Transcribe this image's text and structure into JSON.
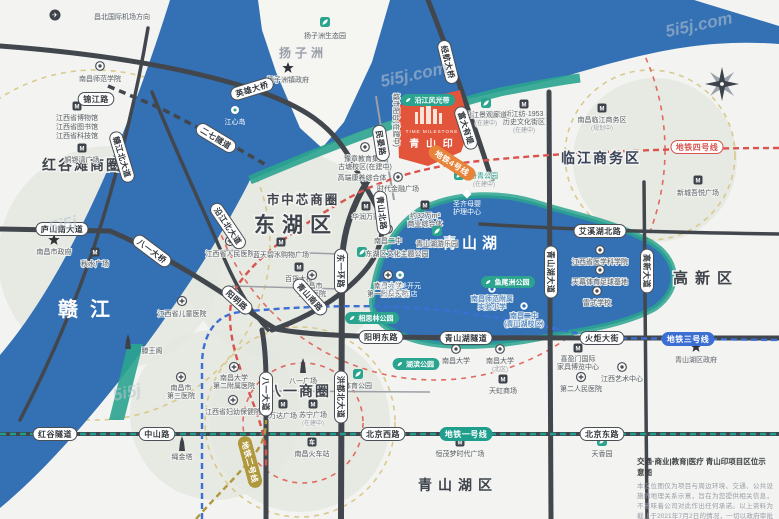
{
  "title": "青山印项目区位示意图",
  "palette": {
    "water": "#3470b4",
    "teal": "#2aa48e",
    "road_dark": "#42474d",
    "road_minor": "#9aa0a6",
    "blob": "#e4e6e1",
    "yellow_dash": "#d8c98c",
    "red_dash": "#e06b5f",
    "metro1": "#1f9e8e",
    "metro2": "#b0983c",
    "metro3": "#3b6fd4",
    "metro4": "#d9534f",
    "orange": "#e8833a",
    "project": "#e2553b"
  },
  "water": {
    "river_path": "M170,0 L694,0 L779,26 L779,44 C700,38 640,54 560,78 C480,96 420,108 360,132 C330,143 300,160 250,180 C220,240 180,300 120,380 C80,430 40,475 0,508 L0,355 C60,285 120,160 170,0 Z",
    "island_path": "M258,0 L390,0 L372,62 L344,122 L322,148 L300,128 L276,72 L262,30 Z",
    "shore_path": "M250,180 C330,146 420,112 500,92 C535,85 558,81 580,78",
    "tengwang_quad": "M128,344 L143,344 L124,420 L109,420 Z",
    "lake_path": "M372,302 C375,262 392,228 420,210 C455,192 500,191 540,204 C575,215 615,222 650,242 C678,258 683,288 655,308 C625,325 580,331 540,338 C500,346 450,350 415,340 C390,332 372,322 372,302 Z"
  },
  "blobs": [
    [
      285,
      255,
      105
    ],
    [
      110,
      258,
      112
    ],
    [
      655,
      160,
      82
    ],
    [
      300,
      422,
      90
    ],
    [
      215,
      415,
      85
    ]
  ],
  "circles": {
    "yellow": [
      [
        95,
        245,
        175
      ],
      [
        300,
        422,
        95
      ],
      [
        650,
        155,
        85
      ]
    ],
    "red": [
      [
        303,
        423,
        60
      ],
      [
        435,
        150,
        230
      ]
    ]
  },
  "roads": {
    "dark": [
      [
        "M0,46 C120,55 200,72 255,90 C302,106 332,124 352,162 C368,193 382,210 382,228 C382,252 368,272 340,294 C318,311 295,322 272,330",
        5
      ],
      [
        "M0,229 L110,231 C152,249 192,273 230,298 C252,313 263,322 276,329 C330,339 420,338 779,338",
        5
      ],
      [
        "M152,92 C176,152 200,202 221,251 C236,287 251,312 268,330",
        3.5
      ],
      [
        "M148,28 C136,100 116,180 93,250 C76,300 51,360 20,420",
        3.5
      ],
      [
        "M368,180 C352,206 343,232 342,262 L341,519",
        6
      ],
      [
        "M262,330 C265,346 266,362 266,382 L266,519",
        5
      ],
      [
        "M0,434 L779,434",
        4
      ],
      [
        "M549,92 L551,519",
        5
      ],
      [
        "M644,182 L647,519",
        3.5
      ],
      [
        "M480,224 C560,229 640,232 779,234",
        3.5
      ],
      [
        "M428,0 C444,40 458,80 470,115 C479,140 486,162 492,180",
        5
      ]
    ],
    "minor": [
      [
        "M376,96 C381,130 388,165 394,200",
        2
      ],
      [
        "M220,250 L340,254",
        1.5
      ],
      [
        "M232,286 L341,289",
        1.5
      ],
      [
        "M266,391 L430,392",
        1.5
      ]
    ],
    "dashed": [
      [
        "M108,86 L160,108 L230,144 L268,166",
        3.5
      ]
    ]
  },
  "road_labels": [
    [
      "锦江路",
      96,
      99,
      0
    ],
    [
      "英雄大桥",
      252,
      89,
      -17
    ],
    [
      "二七隧道",
      216,
      138,
      31
    ],
    [
      "赣江北大道",
      122,
      157,
      73
    ],
    [
      "沿江北大道",
      228,
      226,
      56
    ],
    [
      "庐山南大道",
      62,
      229,
      0
    ],
    [
      "八一大桥",
      152,
      251,
      37
    ],
    [
      "阳明路",
      237,
      300,
      42
    ],
    [
      "青山北路",
      382,
      213,
      83
    ],
    [
      "青山南路",
      310,
      297,
      48
    ],
    [
      "经航大桥",
      448,
      62,
      76
    ],
    [
      "民晏路",
      381,
      143,
      81
    ],
    [
      "富大有堤",
      466,
      128,
      72
    ],
    [
      "阳明东路",
      381,
      337,
      0
    ],
    [
      "青山湖隧道",
      466,
      338,
      0
    ],
    [
      "火炬大街",
      602,
      338,
      0
    ],
    [
      "北京西路",
      383,
      434,
      0
    ],
    [
      "中山路",
      157,
      434,
      0
    ],
    [
      "红谷隧道",
      55,
      434,
      0
    ],
    [
      "北京东路",
      602,
      434,
      0
    ],
    [
      "艾溪湖北路",
      600,
      231,
      0
    ],
    [
      "青山湖大道",
      551,
      272,
      90
    ],
    [
      "高新大道",
      647,
      271,
      90
    ],
    [
      "东一环路",
      341,
      271,
      90
    ],
    [
      "洪都北大道",
      341,
      397,
      90
    ],
    [
      "八一大道",
      266,
      394,
      90
    ]
  ],
  "metro": {
    "lines": [
      {
        "name": "地铁一号线",
        "color": "#1f9e8e",
        "d": "M0,434 L779,434"
      },
      {
        "name": "地铁二号线",
        "color": "#b0983c",
        "d": "M196,519 C218,494 240,474 256,452 C263,443 266,432 266,420"
      },
      {
        "name": "地铁三号线",
        "color": "#3b6fd4",
        "d": "M202,519 L202,365 C202,340 212,315 240,312 C300,306 380,303 450,311 C510,318 560,330 600,338 L779,340"
      },
      {
        "name": "地铁四号线",
        "color": "#d9534f",
        "d": "M779,148 C680,148 560,152 470,162 C420,168 380,180 345,200 C300,226 262,252 240,282 C226,300 228,330 238,362 C250,398 262,420 266,450 L266,468"
      }
    ],
    "labels": [
      {
        "t": "地铁四号线",
        "x": 697,
        "y": 147,
        "r": 0,
        "s": "line4"
      },
      {
        "t": "地铁一号线",
        "x": 466,
        "y": 434,
        "r": 0,
        "s": "teal"
      },
      {
        "t": "地铁三号线",
        "x": 688,
        "y": 339,
        "r": 0,
        "s": "blue"
      },
      {
        "t": "地铁二号线",
        "x": 250,
        "y": 462,
        "r": 75,
        "s": "olive"
      },
      {
        "t": "地铁4号线",
        "x": 452,
        "y": 163,
        "r": 33,
        "s": "orange"
      }
    ]
  },
  "districts": [
    [
      "红谷滩商圈",
      82,
      170,
      14,
      "#3f444c",
      2
    ],
    [
      "扬子洲",
      303,
      57,
      12,
      "#9aa0a8",
      4
    ],
    [
      "市中芯商圈",
      303,
      204,
      12.5,
      "#3f444c",
      2
    ],
    [
      "东湖区",
      296,
      232,
      21,
      "#3f444c",
      7
    ],
    [
      "临江商务区",
      601,
      163,
      14,
      "#3a4258",
      2
    ],
    [
      "青山湖",
      472,
      248,
      15,
      "#ffffff",
      5
    ],
    [
      "赣江",
      90,
      316,
      20,
      "#ffffff",
      12
    ],
    [
      "高新区",
      706,
      283,
      15,
      "#3f444c",
      7
    ],
    [
      "八一商圈",
      299,
      396,
      14,
      "#3f444c",
      2
    ],
    [
      "青山湖区",
      458,
      490,
      14,
      "#3f444c",
      6
    ]
  ],
  "project": {
    "name_en": "TIME MILESTONE",
    "name_zh": "青 山 印",
    "polygon": "397,106 460,90 470,127 461,152 428,166 399,158",
    "bars": [
      [
        415,
        112,
        3,
        12
      ],
      [
        420,
        107,
        4,
        17
      ],
      [
        426,
        104,
        5,
        20
      ],
      [
        433,
        109,
        4,
        15
      ],
      [
        439,
        113,
        3,
        11
      ]
    ],
    "en_pos": [
      432,
      133
    ],
    "zh_pos": [
      432,
      147
    ]
  },
  "teal_labels": [
    {
      "t": "沿江风光带",
      "x": 428,
      "y": 100
    },
    {
      "t": "湖滨公园",
      "x": 416,
      "y": 364
    },
    {
      "t": "相思林公园",
      "x": 372,
      "y": 318
    },
    {
      "t": "鱼尾洲公园",
      "x": 508,
      "y": 282
    }
  ],
  "pois": [
    {
      "i": "plane",
      "x": 55,
      "y": 15,
      "t": [
        [
          "昌北国际机场方向",
          122,
          19,
          "g"
        ]
      ]
    },
    {
      "i": "school",
      "x": 100,
      "y": 66,
      "t": [
        [
          "南昌师范学院",
          100,
          81,
          "g"
        ]
      ]
    },
    {
      "i": "mall",
      "x": 77,
      "y": 106,
      "t": [
        [
          "江西省博物馆",
          77,
          120,
          "g"
        ],
        [
          "江西省图书馆",
          77,
          129,
          "g"
        ],
        [
          "江西省科技馆",
          77,
          138,
          "g"
        ]
      ]
    },
    {
      "i": "mall",
      "x": 82,
      "y": 148,
      "t": [
        [
          "铜锣湾广场",
          82,
          162,
          "g"
        ]
      ]
    },
    {
      "i": "star",
      "x": 54,
      "y": 240,
      "t": [
        [
          "南昌市政府",
          54,
          254,
          "g"
        ]
      ]
    },
    {
      "i": "mall",
      "x": 95,
      "y": 252,
      "t": [
        [
          "秋水广场",
          95,
          266,
          "g"
        ]
      ]
    },
    {
      "i": "star",
      "x": 288,
      "y": 68,
      "t": [
        [
          "扬子洲镇政府",
          288,
          82,
          "g"
        ]
      ]
    },
    {
      "i": "park",
      "x": 325,
      "y": 22,
      "t": [
        [
          "扬子洲生态园",
          325,
          38,
          "g"
        ]
      ]
    },
    {
      "i": "dotw",
      "x": 235,
      "y": 110,
      "t": [
        [
          "江心岛",
          235,
          124,
          "w"
        ]
      ]
    },
    {
      "i": "tower",
      "x": 128,
      "y": 342,
      "t": [
        [
          "滕王阁",
          152,
          353,
          "g"
        ]
      ]
    },
    {
      "i": "hosp",
      "x": 182,
      "y": 301,
      "t": [
        [
          "江西省儿童医院",
          182,
          316,
          "g"
        ]
      ]
    },
    {
      "i": "hosp",
      "x": 230,
      "y": 241,
      "t": [
        [
          "江西省人民医院",
          230,
          256,
          "g"
        ]
      ]
    },
    {
      "i": "mall",
      "x": 281,
      "y": 242,
      "t": [
        [
          "蓝天碧水购物广场",
          281,
          257,
          "g"
        ]
      ]
    },
    {
      "i": "mall",
      "x": 299,
      "y": 267,
      "t": [
        [
          "百货大楼",
          299,
          281,
          "g"
        ]
      ]
    },
    {
      "i": "hosp",
      "x": 312,
      "y": 275,
      "t": [
        [
          "南昌市",
          312,
          288,
          "g"
        ],
        [
          "第一医院",
          312,
          296,
          "g"
        ]
      ]
    },
    {
      "i": "hosp",
      "x": 388,
      "y": 275,
      "t": [
        [
          "南昌大学",
          388,
          288,
          "g"
        ],
        [
          "第一附属医院",
          388,
          296,
          "g"
        ]
      ]
    },
    {
      "i": "school",
      "x": 365,
      "y": 147,
      "t": [
        [
          "豫章教育集团",
          365,
          161,
          "g"
        ],
        [
          "古塘校区(在建中)",
          365,
          169,
          "g"
        ]
      ]
    },
    {
      "i": "none",
      "x": 0,
      "y": 0,
      "t": [
        [
          "高端康养综合体",
          362,
          180,
          "g"
        ]
      ]
    },
    {
      "i": "dot",
      "x": 398,
      "y": 177,
      "t": [
        [
          "时代金融广场",
          398,
          191,
          "g"
        ]
      ]
    },
    {
      "i": "mall",
      "x": 425,
      "y": 205,
      "t": [
        [
          "约32万m²",
          425,
          218,
          "g"
        ],
        [
          "商业综合体",
          425,
          226,
          "g"
        ]
      ]
    },
    {
      "i": "mall",
      "x": 366,
      "y": 206,
      "t": [
        [
          "华润万家",
          366,
          219,
          "g"
        ]
      ]
    },
    {
      "i": "school",
      "x": 388,
      "y": 229,
      "t": [
        [
          "南昌二中",
          388,
          243,
          "g"
        ]
      ]
    },
    {
      "i": "park",
      "x": 362,
      "y": 252,
      "t": [
        [
          "东湖区文化主题公园",
          397,
          256,
          "g"
        ]
      ]
    },
    {
      "i": "park",
      "x": 437,
      "y": 231,
      "t": [
        [
          "青山湖游乐园",
          437,
          246,
          "g"
        ]
      ]
    },
    {
      "i": "diam",
      "x": 467,
      "y": 194,
      "t": [
        [
          "圣齐母婴",
          467,
          206,
          "w"
        ],
        [
          "护理中心",
          467,
          214,
          "w"
        ]
      ]
    },
    {
      "i": "park",
      "x": 459,
      "y": 175,
      "t": [
        [
          "丹青公园",
          484,
          178,
          "t"
        ],
        [
          "(在建中)",
          484,
          186,
          "s"
        ]
      ]
    },
    {
      "i": "dotw",
      "x": 400,
      "y": 275,
      "t": [
        [
          "南昌凯美开元",
          400,
          288,
          "w"
        ],
        [
          "名都大酒店",
          400,
          296,
          "w"
        ]
      ]
    },
    {
      "i": "schoolb",
      "x": 492,
      "y": 289,
      "t": [
        [
          "南昌师范附属",
          492,
          301,
          "b"
        ],
        [
          "实验小学",
          492,
          309,
          "b"
        ]
      ]
    },
    {
      "i": "schoolb",
      "x": 524,
      "y": 306,
      "t": [
        [
          "南昌二中",
          524,
          318,
          "b"
        ],
        [
          "(青山湖校区)",
          524,
          326,
          "b"
        ]
      ]
    },
    {
      "i": "park",
      "x": 358,
      "y": 374,
      "t": [
        [
          "体育公园",
          358,
          388,
          "g"
        ]
      ]
    },
    {
      "i": "tower",
      "x": 303,
      "y": 366,
      "t": [
        [
          "八一广场",
          303,
          383,
          "g"
        ]
      ]
    },
    {
      "i": "mall",
      "x": 283,
      "y": 404,
      "t": [
        [
          "万达广场",
          283,
          418,
          "g"
        ]
      ]
    },
    {
      "i": "mall",
      "x": 313,
      "y": 404,
      "t": [
        [
          "苏宁广场",
          313,
          417,
          "g"
        ],
        [
          "(在建中)",
          313,
          425,
          "s"
        ]
      ]
    },
    {
      "i": "train",
      "x": 312,
      "y": 442,
      "t": [
        [
          "南昌火车站",
          312,
          456,
          "g"
        ]
      ]
    },
    {
      "i": "tower",
      "x": 182,
      "y": 444,
      "t": [
        [
          "绳金塔",
          182,
          459,
          "g"
        ]
      ]
    },
    {
      "i": "hosp",
      "x": 181,
      "y": 377,
      "t": [
        [
          "南昌市",
          181,
          390,
          "g"
        ],
        [
          "第三医院",
          181,
          398,
          "g"
        ]
      ]
    },
    {
      "i": "hosp",
      "x": 234,
      "y": 367,
      "t": [
        [
          "南昌大学",
          234,
          380,
          "g"
        ],
        [
          "第二附属医院",
          234,
          388,
          "g"
        ]
      ]
    },
    {
      "i": "hosp",
      "x": 233,
      "y": 400,
      "t": [
        [
          "江西省妇幼保健院",
          233,
          414,
          "g"
        ]
      ]
    },
    {
      "i": "school",
      "x": 456,
      "y": 349,
      "t": [
        [
          "南昌大学",
          456,
          363,
          "g"
        ]
      ]
    },
    {
      "i": "school",
      "x": 500,
      "y": 349,
      "t": [
        [
          "南昌大学",
          500,
          363,
          "g"
        ],
        [
          "(北区)",
          500,
          371,
          "s"
        ]
      ]
    },
    {
      "i": "mall",
      "x": 503,
      "y": 379,
      "t": [
        [
          "天虹商场",
          503,
          393,
          "g"
        ]
      ]
    },
    {
      "i": "mall",
      "x": 460,
      "y": 442,
      "t": [
        [
          "恒茂梦时代广场",
          460,
          456,
          "g"
        ]
      ]
    },
    {
      "i": "mall",
      "x": 578,
      "y": 348,
      "t": [
        [
          "喜盈门国际",
          578,
          361,
          "g"
        ],
        [
          "家具博览中心",
          578,
          369,
          "g"
        ]
      ]
    },
    {
      "i": "dot",
      "x": 622,
      "y": 367,
      "t": [
        [
          "江西艺术中心",
          622,
          381,
          "g"
        ]
      ]
    },
    {
      "i": "hosp",
      "x": 581,
      "y": 377,
      "t": [
        [
          "第二人民医院",
          581,
          391,
          "g"
        ]
      ]
    },
    {
      "i": "star",
      "x": 696,
      "y": 347,
      "t": [
        [
          "青山湖区政府",
          696,
          362,
          "g"
        ]
      ]
    },
    {
      "i": "park",
      "x": 602,
      "y": 441,
      "t": [
        [
          "天香园",
          602,
          456,
          "g"
        ]
      ]
    },
    {
      "i": "mall",
      "x": 698,
      "y": 180,
      "t": [
        [
          "新城吾悦广场",
          698,
          195,
          "g"
        ]
      ]
    },
    {
      "i": "mall",
      "x": 602,
      "y": 108,
      "t": [
        [
          "南昌临江商务区",
          602,
          122,
          "g"
        ],
        [
          "(规划中)",
          602,
          130,
          "s"
        ]
      ]
    },
    {
      "i": "mall",
      "x": 524,
      "y": 104,
      "t": [
        [
          "新江纺·1953",
          524,
          116,
          "g"
        ],
        [
          "历史文化街区",
          524,
          124,
          "g"
        ],
        [
          "(在建中)",
          524,
          132,
          "s"
        ]
      ]
    },
    {
      "i": "park",
      "x": 486,
      "y": 103,
      "t": [
        [
          "沿江景观廊道",
          486,
          117,
          "g"
        ],
        [
          "(在建中)",
          486,
          125,
          "s"
        ]
      ]
    },
    {
      "i": "school",
      "x": 600,
      "y": 250,
      "t": [
        [
          "江西省医学科学院",
          600,
          264,
          "g"
        ]
      ]
    },
    {
      "i": "dot",
      "x": 600,
      "y": 270,
      "t": [
        [
          "天幕体育足球基地",
          600,
          284,
          "g"
        ]
      ]
    },
    {
      "i": "school",
      "x": 597,
      "y": 291,
      "t": [
        [
          "雷式学校",
          597,
          305,
          "g"
        ]
      ]
    },
    {
      "i": "none",
      "x": 0,
      "y": 0,
      "t": [
        [
          "城市阳台(在建中)",
          394,
          120,
          "g",
          90
        ]
      ]
    }
  ],
  "compass": {
    "x": 722,
    "y": 84
  },
  "watermarks": [
    {
      "t": "5i5j.com",
      "x": 415,
      "y": 80
    },
    {
      "t": "5i5j.com",
      "x": 700,
      "y": 30
    },
    {
      "t": "5i5j",
      "x": 64,
      "y": 230
    },
    {
      "t": "5i5j",
      "x": 128,
      "y": 398
    }
  ],
  "disclaimer": {
    "title": "交通·商业|教育|医疗 青山印项目区位示意图",
    "body": "本区位图仅为项目与周边环境、交通、公共设施的地理关系示意，旨在为您提供相关信息，不意味着公司对此作出任何承诺。以上资料为截止于2021年7月2日的情况，一切以政府审批文件为准，恕不另行通知。"
  }
}
